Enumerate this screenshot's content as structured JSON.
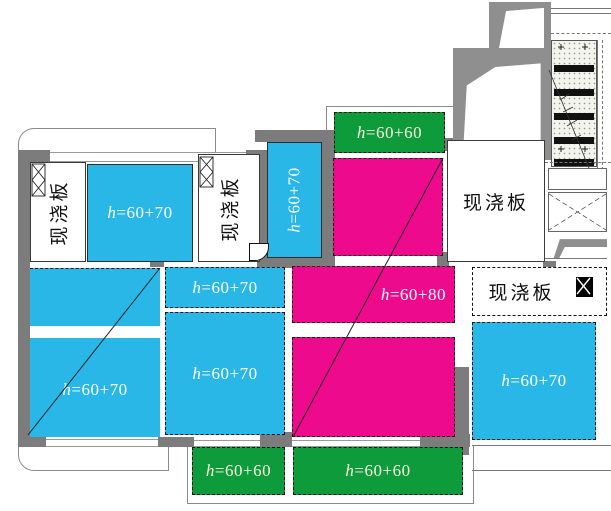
{
  "colors": {
    "cyan": "#29B7E8",
    "magenta": "#EE0A8C",
    "green": "#0D9B3C",
    "wall": "#7C7C7C",
    "wall-light": "#8F8F8F",
    "label-white": "#FFFFFF",
    "label-cream": "#F8F8DC"
  },
  "slabs": {
    "top_left": {
      "label": "h=60+70"
    },
    "vertical_strip": {
      "label": "h=60+70"
    },
    "green_top": {
      "label": "h=60+60"
    },
    "mid_upper": {
      "label": "h=60+70"
    },
    "mid_lower": {
      "label": "h=60+70"
    },
    "left_big": {
      "label": "h=60+70"
    },
    "magenta_mid": {
      "label": "h=60+80"
    },
    "right_lower": {
      "label": "h=60+70"
    },
    "green_bottom_left": {
      "label": "h=60+60"
    },
    "green_bottom_right": {
      "label": "h=60+60"
    }
  },
  "rooms": {
    "cast_top_left": {
      "label": "现浇板"
    },
    "cast_top_mid": {
      "label": "现浇板"
    },
    "cast_right": {
      "label": "现浇板"
    },
    "cast_right_lower": {
      "label": "现浇板"
    }
  }
}
